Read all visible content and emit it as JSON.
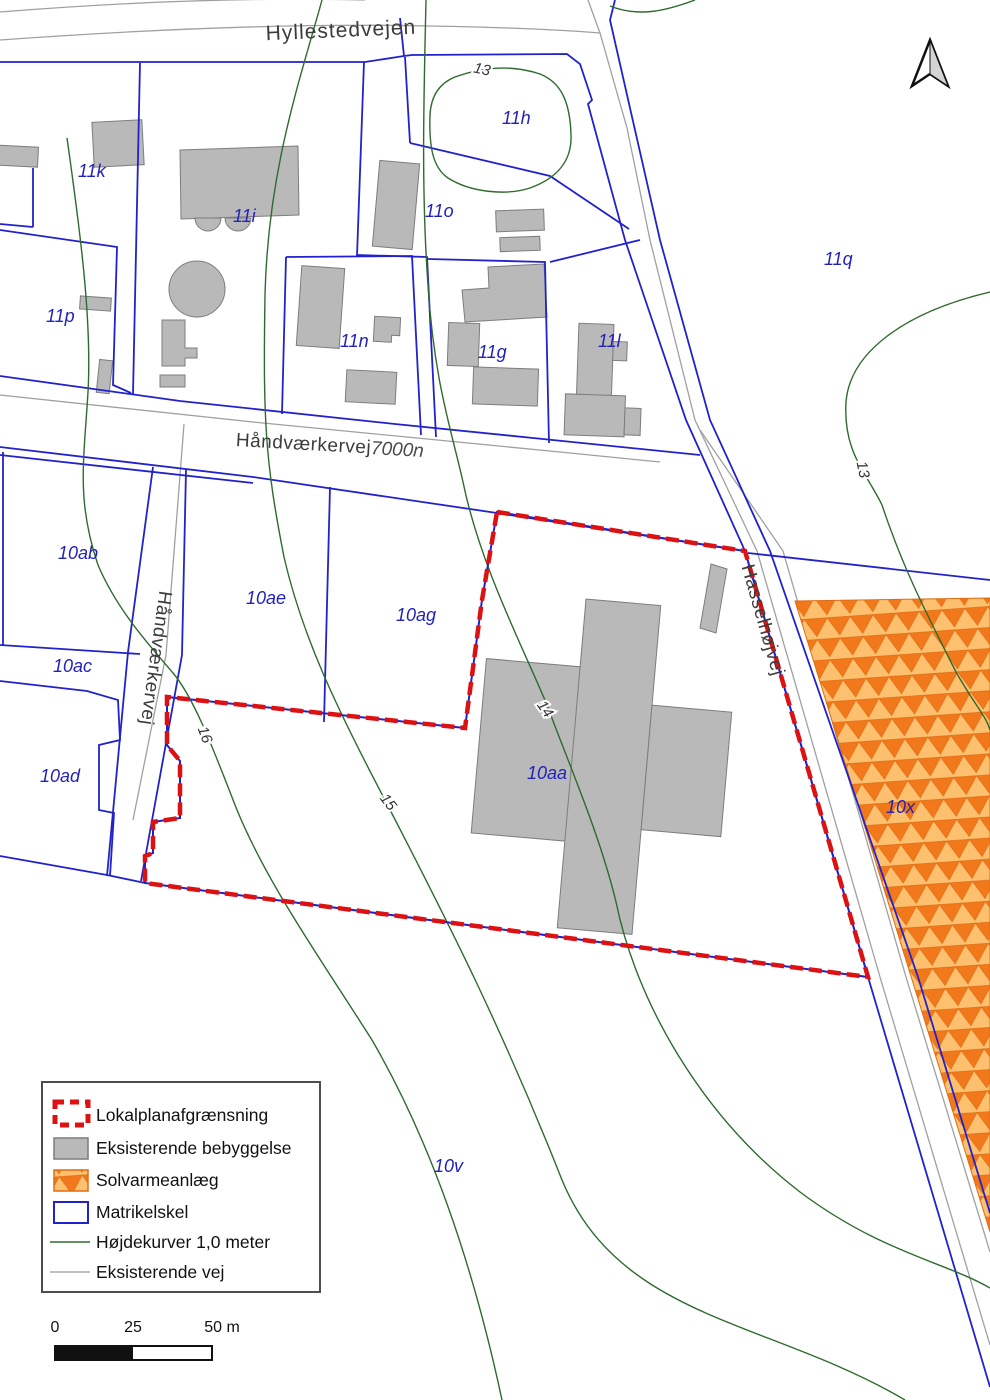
{
  "map_type": "lokalplan-kort",
  "colors": {
    "matrikel_blue": "#2222cc",
    "plan_boundary_red": "#dd1111",
    "building_gray": "#b9b9b9",
    "contour_green": "#2e6b2e",
    "road_gray": "#a0a0a0",
    "solar_bg_orange": "#fcc06f",
    "solar_triangle_orange": "#f1791c",
    "parcel_label_blue": "#2222bb"
  },
  "parcel_labels": [
    "11k",
    "11i",
    "11o",
    "11h",
    "11q",
    "11p",
    "11n",
    "11g",
    "11l",
    "10ab",
    "10ae",
    "10ag",
    "10ac",
    "10ad",
    "10aa",
    "10x",
    "10v"
  ],
  "contour_labels": [
    "13",
    "13",
    "14",
    "15",
    "16"
  ],
  "road_labels": {
    "hyllestedvejen": "Hyllestedvejen",
    "haandvaerkervej": "Håndværkervej",
    "haandvaerkervej_nr": "7000n",
    "haandvaerkervej_syd": "Håndværkervej",
    "hasselhoejvej": "Hasselhøjvej"
  },
  "legend": {
    "items": [
      {
        "label": "Lokalplanafgrænsning",
        "symbol": "plan-boundary-swatch"
      },
      {
        "label": "Eksisterende bebyggelse",
        "symbol": "building-swatch"
      },
      {
        "label": "Solvarmeanlæg",
        "symbol": "solar-swatch"
      },
      {
        "label": "Matrikelskel",
        "symbol": "matrikel-swatch"
      },
      {
        "label": "Højdekurver 1,0 meter",
        "symbol": "contour-swatch"
      },
      {
        "label": "Eksisterende vej",
        "symbol": "road-swatch"
      }
    ]
  },
  "scalebar": {
    "t0": "0",
    "t25": "25",
    "t50": "50 m"
  }
}
